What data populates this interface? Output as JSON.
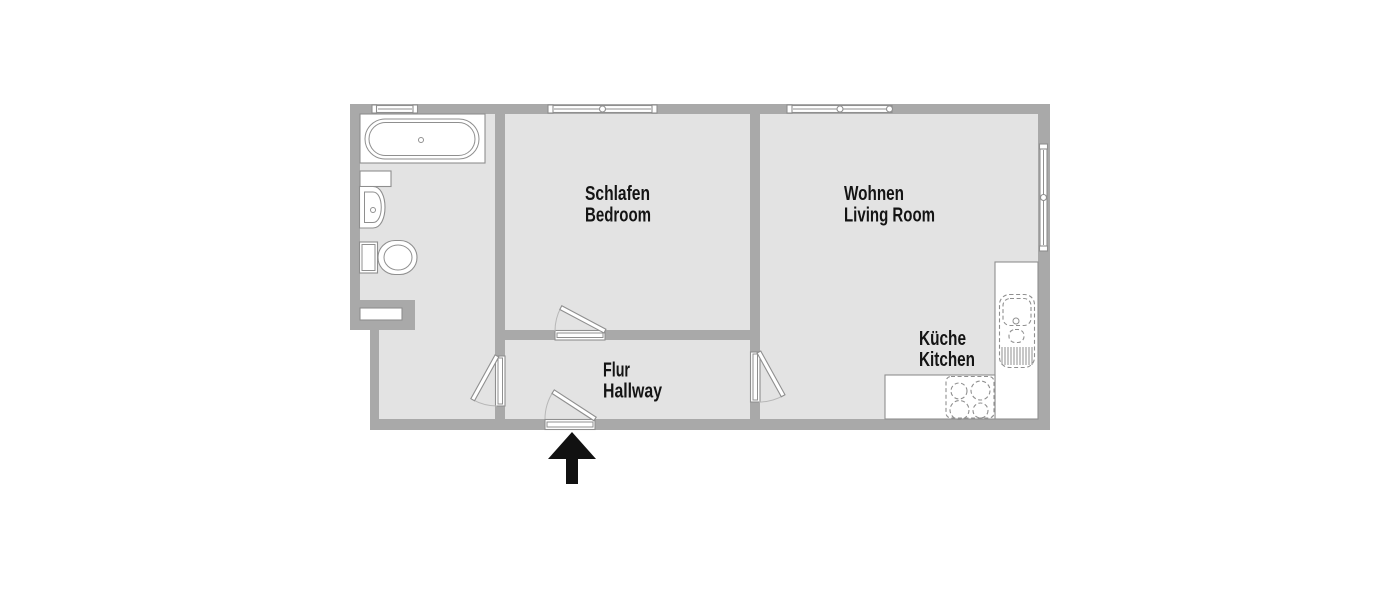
{
  "colors": {
    "wall": "#a9a9a9",
    "floor": "#e3e3e3",
    "outline": "#8f8f8f",
    "fixture_fill": "#ffffff",
    "text": "#141414",
    "arrow": "#111111",
    "background": "#ffffff"
  },
  "rooms": {
    "bedroom": {
      "label_de": "Schlafen",
      "label_en": "Bedroom"
    },
    "living": {
      "label_de": "Wohnen",
      "label_en": "Living Room"
    },
    "kitchen": {
      "label_de": "Küche",
      "label_en": "Kitchen"
    },
    "hallway": {
      "label_de": "Flur",
      "label_en": "Hallway"
    }
  },
  "fixtures": {
    "bathtub": "bathtub",
    "washbasin": "washbasin",
    "toilet": "toilet",
    "kitchen_sink": "kitchen-sink",
    "stove": "stove-4-burners",
    "entrance": "entrance-arrow"
  }
}
